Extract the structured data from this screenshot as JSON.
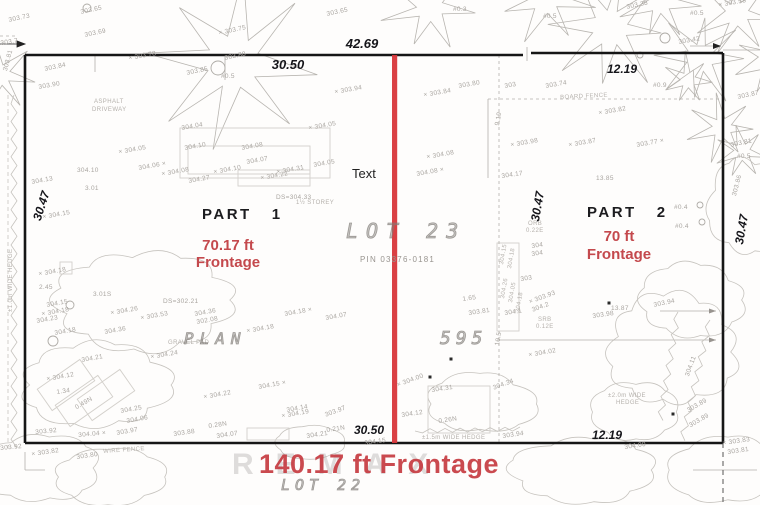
{
  "colors": {
    "red_line": "#d8363a",
    "red_text": "#c4494d",
    "red_big": "#c63b41",
    "boundary": "#161616",
    "faint_ink": "#a9a5a0"
  },
  "parcel": {
    "part1_label": "PART",
    "part1_number": "1",
    "part1_frontage_line1": "70.17 ft",
    "part1_frontage_line2": "Frontage",
    "part2_label": "PART",
    "part2_number": "2",
    "part2_frontage_line1": "70 ft",
    "part2_frontage_line2": "Frontage",
    "lot_label": "LOT  23",
    "pin_label": "PIN 03376-0181",
    "plan_label": "PLAN",
    "plan_number": "595",
    "lot_below_label": "LOT  22",
    "total_frontage": "140.17 ft Frontage",
    "center_note": "Text",
    "watermark": "REMAX"
  },
  "dimensions": {
    "top_total": "42.69",
    "top_left": "30.50",
    "top_right": "12.19",
    "bottom_left": "30.50",
    "bottom_right": "12.19",
    "side_left": "30.47",
    "side_middle": "30.47",
    "side_right": "30.47"
  },
  "survey_labels": [
    {
      "t": "303.73",
      "x": 8,
      "y": 17,
      "r": -12
    },
    {
      "t": "303.65",
      "x": 80,
      "y": 9,
      "r": -12
    },
    {
      "t": "303.69",
      "x": 84,
      "y": 32,
      "r": -12
    },
    {
      "t": "303.7",
      "x": 0,
      "y": 40,
      "r": -8
    },
    {
      "t": "× 303.78",
      "x": 128,
      "y": 55,
      "r": -10
    },
    {
      "t": "303.84",
      "x": 44,
      "y": 66,
      "r": -12
    },
    {
      "t": "303.81",
      "x": 2,
      "y": 70,
      "r": -75
    },
    {
      "t": "303.90",
      "x": 38,
      "y": 84,
      "r": -10
    },
    {
      "t": "303.85",
      "x": 186,
      "y": 70,
      "r": -12
    },
    {
      "t": "303.88",
      "x": 224,
      "y": 55,
      "r": -12
    },
    {
      "t": "#0.5",
      "x": 221,
      "y": 73,
      "r": 0
    },
    {
      "t": "× 303.75",
      "x": 218,
      "y": 30,
      "r": -12
    },
    {
      "t": "× 303.94",
      "x": 334,
      "y": 89,
      "r": -10
    },
    {
      "t": "303.65",
      "x": 326,
      "y": 11,
      "r": -12
    },
    {
      "t": "#0.3",
      "x": 453,
      "y": 6,
      "r": 0
    },
    {
      "t": "#0.5",
      "x": 543,
      "y": 13,
      "r": 0
    },
    {
      "t": "303.38",
      "x": 626,
      "y": 4,
      "r": -12
    },
    {
      "t": "× 303.58",
      "x": 718,
      "y": 2,
      "r": -10
    },
    {
      "t": "#0.5",
      "x": 690,
      "y": 10,
      "r": 0
    },
    {
      "t": "303.42",
      "x": 678,
      "y": 39,
      "r": -10
    },
    {
      "t": "#0.9",
      "x": 653,
      "y": 82,
      "r": 0
    },
    {
      "t": "ASPHALT",
      "x": 94,
      "y": 99,
      "r": 0,
      "c": "xs"
    },
    {
      "t": "DRIVEWAY",
      "x": 92,
      "y": 107,
      "r": 0,
      "c": "xs"
    },
    {
      "t": "BOARD FENCE",
      "x": 560,
      "y": 95,
      "r": -3,
      "c": "xs"
    },
    {
      "t": "303.80",
      "x": 458,
      "y": 83,
      "r": -10
    },
    {
      "t": "× 303.84",
      "x": 423,
      "y": 92,
      "r": -10
    },
    {
      "t": "303",
      "x": 504,
      "y": 83,
      "r": -10
    },
    {
      "t": "303.74",
      "x": 545,
      "y": 83,
      "r": -10
    },
    {
      "t": "× 303.82",
      "x": 598,
      "y": 110,
      "r": -10
    },
    {
      "t": "× 303.98",
      "x": 510,
      "y": 142,
      "r": -10
    },
    {
      "t": "× 303.87",
      "x": 568,
      "y": 142,
      "r": -10
    },
    {
      "t": "303.77 ×",
      "x": 636,
      "y": 142,
      "r": -10
    },
    {
      "t": "13.85",
      "x": 596,
      "y": 175,
      "r": 0
    },
    {
      "t": "9.19",
      "x": 494,
      "y": 125,
      "r": -80
    },
    {
      "t": "304.04",
      "x": 181,
      "y": 125,
      "r": -10
    },
    {
      "t": "× 304.05",
      "x": 308,
      "y": 125,
      "r": -10
    },
    {
      "t": "× 304.05",
      "x": 118,
      "y": 149,
      "r": -10
    },
    {
      "t": "304.10",
      "x": 184,
      "y": 145,
      "r": -10
    },
    {
      "t": "304.08",
      "x": 241,
      "y": 145,
      "r": -10
    },
    {
      "t": "304.07",
      "x": 246,
      "y": 159,
      "r": -10
    },
    {
      "t": "304.06 ×",
      "x": 138,
      "y": 165,
      "r": -10
    },
    {
      "t": "× 304.08",
      "x": 161,
      "y": 171,
      "r": -10
    },
    {
      "t": "× 304.10",
      "x": 213,
      "y": 169,
      "r": -10
    },
    {
      "t": "304.27",
      "x": 188,
      "y": 178,
      "r": -10
    },
    {
      "t": "× 304.22",
      "x": 260,
      "y": 175,
      "r": -10
    },
    {
      "t": "× 304.31",
      "x": 276,
      "y": 169,
      "r": -10
    },
    {
      "t": "304.05",
      "x": 313,
      "y": 162,
      "r": -10
    },
    {
      "t": "DS=304.33",
      "x": 276,
      "y": 194,
      "r": 0
    },
    {
      "t": "1½ STOREY",
      "x": 296,
      "y": 200,
      "r": 0,
      "c": "xs"
    },
    {
      "t": "304.13",
      "x": 31,
      "y": 179,
      "r": -10
    },
    {
      "t": "304.10",
      "x": 77,
      "y": 167,
      "r": 0
    },
    {
      "t": "3.01",
      "x": 85,
      "y": 185,
      "r": 0
    },
    {
      "t": "× 304.15",
      "x": 42,
      "y": 214,
      "r": -10
    },
    {
      "t": "× 304.18",
      "x": 38,
      "y": 271,
      "r": -10
    },
    {
      "t": "2.45",
      "x": 39,
      "y": 284,
      "r": 0
    },
    {
      "t": "3.01S",
      "x": 93,
      "y": 291,
      "r": 0
    },
    {
      "t": "304.15",
      "x": 46,
      "y": 302,
      "r": -10
    },
    {
      "t": "× 304.18",
      "x": 41,
      "y": 311,
      "r": -10
    },
    {
      "t": "304.23",
      "x": 36,
      "y": 318,
      "r": -10
    },
    {
      "t": "304.18",
      "x": 54,
      "y": 330,
      "r": -10
    },
    {
      "t": "DS=302.21",
      "x": 163,
      "y": 298,
      "r": 0
    },
    {
      "t": "× 304.26",
      "x": 110,
      "y": 310,
      "r": -10
    },
    {
      "t": "× 303.53",
      "x": 140,
      "y": 315,
      "r": -10
    },
    {
      "t": "304.36",
      "x": 194,
      "y": 311,
      "r": -10
    },
    {
      "t": "302.08",
      "x": 196,
      "y": 319,
      "r": -10
    },
    {
      "t": "304.36",
      "x": 104,
      "y": 329,
      "r": -10
    },
    {
      "t": "304.18 ×",
      "x": 284,
      "y": 311,
      "r": -10
    },
    {
      "t": "304.07",
      "x": 325,
      "y": 315,
      "r": -10
    },
    {
      "t": "× 304.18",
      "x": 246,
      "y": 328,
      "r": -10
    },
    {
      "t": "GRAVEL PAD",
      "x": 168,
      "y": 340,
      "r": 0,
      "c": "xs"
    },
    {
      "t": "× 304.24",
      "x": 150,
      "y": 354,
      "r": -10
    },
    {
      "t": "304.21",
      "x": 81,
      "y": 357,
      "r": -10
    },
    {
      "t": "× 304.12",
      "x": 46,
      "y": 376,
      "r": -10
    },
    {
      "t": "1.34",
      "x": 56,
      "y": 389,
      "r": -8
    },
    {
      "t": "0.49N",
      "x": 74,
      "y": 405,
      "r": -30
    },
    {
      "t": "304.25",
      "x": 120,
      "y": 408,
      "r": -10
    },
    {
      "t": "304.06",
      "x": 126,
      "y": 418,
      "r": -10
    },
    {
      "t": "303.92",
      "x": 35,
      "y": 429,
      "r": -5
    },
    {
      "t": "304.04 ×",
      "x": 78,
      "y": 432,
      "r": -5
    },
    {
      "t": "303.97",
      "x": 116,
      "y": 430,
      "r": -10
    },
    {
      "t": "303.92",
      "x": 0,
      "y": 445,
      "r": -5
    },
    {
      "t": "× 303.82",
      "x": 31,
      "y": 451,
      "r": -8
    },
    {
      "t": "303.80",
      "x": 76,
      "y": 454,
      "r": -8
    },
    {
      "t": "WIRE FENCE",
      "x": 103,
      "y": 449,
      "r": -4,
      "c": "xs"
    },
    {
      "t": "304.15 ×",
      "x": 258,
      "y": 384,
      "r": -10
    },
    {
      "t": "× 304.22",
      "x": 203,
      "y": 394,
      "r": -10
    },
    {
      "t": "304.14",
      "x": 286,
      "y": 407,
      "r": -10
    },
    {
      "t": "× 304.19",
      "x": 281,
      "y": 413,
      "r": -10
    },
    {
      "t": "303.97",
      "x": 324,
      "y": 412,
      "r": -20
    },
    {
      "t": "0.28N",
      "x": 208,
      "y": 423,
      "r": -8
    },
    {
      "t": "0.21N",
      "x": 326,
      "y": 427,
      "r": -8
    },
    {
      "t": "304.21",
      "x": 306,
      "y": 433,
      "r": -8
    },
    {
      "t": "304.07",
      "x": 216,
      "y": 433,
      "r": -8
    },
    {
      "t": "303.88",
      "x": 173,
      "y": 431,
      "r": -8
    },
    {
      "t": "× 304.00",
      "x": 396,
      "y": 382,
      "r": -20
    },
    {
      "t": "304.31",
      "x": 431,
      "y": 387,
      "r": -8
    },
    {
      "t": "0.26N",
      "x": 438,
      "y": 418,
      "r": -8
    },
    {
      "t": "304.12",
      "x": 401,
      "y": 412,
      "r": -8
    },
    {
      "t": "304.34",
      "x": 492,
      "y": 385,
      "r": -20
    },
    {
      "t": "±1.5m WIDE HEDGE",
      "x": 422,
      "y": 435,
      "r": 0,
      "c": "xs"
    },
    {
      "t": "303.94",
      "x": 502,
      "y": 433,
      "r": -8
    },
    {
      "t": "304.15",
      "x": 364,
      "y": 440,
      "r": -8
    },
    {
      "t": "304.00",
      "x": 624,
      "y": 444,
      "r": -8
    },
    {
      "t": "× 303.83",
      "x": 722,
      "y": 440,
      "r": -8
    },
    {
      "t": "303.81",
      "x": 727,
      "y": 449,
      "r": -8
    },
    {
      "t": "× 304.08",
      "x": 426,
      "y": 154,
      "r": -10
    },
    {
      "t": "304.08 ×",
      "x": 416,
      "y": 171,
      "r": -10
    },
    {
      "t": "304.17",
      "x": 501,
      "y": 173,
      "r": -8
    },
    {
      "t": "1.65",
      "x": 462,
      "y": 296,
      "r": -8
    },
    {
      "t": "303.81",
      "x": 468,
      "y": 310,
      "r": -8
    },
    {
      "t": "304.1",
      "x": 504,
      "y": 310,
      "r": -8
    },
    {
      "t": "× 303.93",
      "x": 528,
      "y": 299,
      "r": -20
    },
    {
      "t": "304.2",
      "x": 531,
      "y": 307,
      "r": -20
    },
    {
      "t": "SRB",
      "x": 538,
      "y": 317,
      "r": 0,
      "c": "xs"
    },
    {
      "t": "0.12E",
      "x": 536,
      "y": 324,
      "r": 0,
      "c": "xs"
    },
    {
      "t": "ORB",
      "x": 528,
      "y": 221,
      "r": 0,
      "c": "xs"
    },
    {
      "t": "0.22E",
      "x": 526,
      "y": 228,
      "r": 0,
      "c": "xs"
    },
    {
      "t": "× 304.02",
      "x": 528,
      "y": 352,
      "r": -10
    },
    {
      "t": "10.5",
      "x": 494,
      "y": 345,
      "r": -80
    },
    {
      "t": "304",
      "x": 531,
      "y": 243,
      "r": -8
    },
    {
      "t": "304",
      "x": 531,
      "y": 251,
      "r": -8
    },
    {
      "t": "303",
      "x": 520,
      "y": 276,
      "r": -8
    },
    {
      "t": "304.15",
      "x": 499,
      "y": 264,
      "r": -80,
      "c": "xs"
    },
    {
      "t": "304.18",
      "x": 507,
      "y": 268,
      "r": -80,
      "c": "xs"
    },
    {
      "t": "304.26",
      "x": 500,
      "y": 298,
      "r": -80,
      "c": "xs"
    },
    {
      "t": "304.05",
      "x": 508,
      "y": 302,
      "r": -80,
      "c": "xs"
    },
    {
      "t": "304.18",
      "x": 515,
      "y": 312,
      "r": -80,
      "c": "xs"
    },
    {
      "t": "13.87",
      "x": 611,
      "y": 305,
      "r": 0
    },
    {
      "t": "303.98",
      "x": 592,
      "y": 313,
      "r": -8
    },
    {
      "t": "303.94",
      "x": 653,
      "y": 302,
      "r": -12
    },
    {
      "t": "304.11",
      "x": 684,
      "y": 375,
      "r": -70
    },
    {
      "t": "±2.0m WIDE",
      "x": 608,
      "y": 393,
      "r": 0,
      "c": "xs"
    },
    {
      "t": "HEDGE",
      "x": 616,
      "y": 400,
      "r": 0,
      "c": "xs"
    },
    {
      "t": "303.89",
      "x": 686,
      "y": 408,
      "r": -30
    },
    {
      "t": "303.89",
      "x": 688,
      "y": 423,
      "r": -30
    },
    {
      "t": "#0.4",
      "x": 674,
      "y": 204,
      "r": 0
    },
    {
      "t": "#0.4",
      "x": 675,
      "y": 223,
      "r": 0
    },
    {
      "t": "303.87",
      "x": 737,
      "y": 94,
      "r": -12
    },
    {
      "t": "303.81",
      "x": 730,
      "y": 142,
      "r": -12
    },
    {
      "t": "#0.5",
      "x": 737,
      "y": 153,
      "r": 0
    },
    {
      "t": "303.86",
      "x": 731,
      "y": 195,
      "r": -75
    },
    {
      "t": "±1.0m WIDE HEDGE",
      "x": 8,
      "y": 312,
      "r": -90,
      "c": "xs"
    }
  ]
}
